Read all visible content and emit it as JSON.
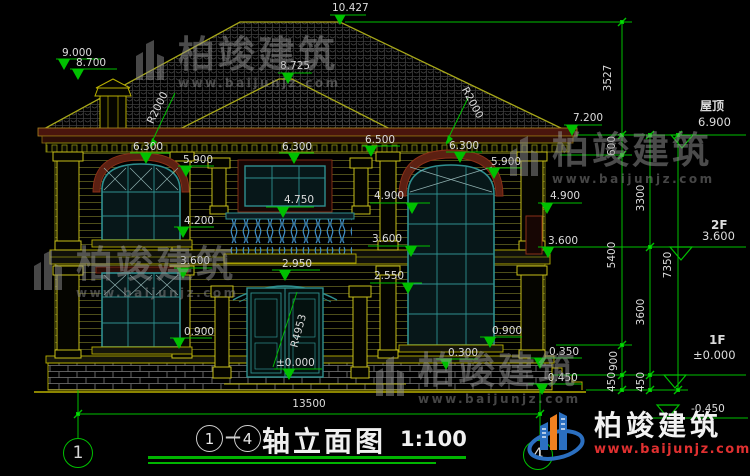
{
  "drawing": {
    "levels": {
      "apex": "10.427",
      "front_ridge": "8.725",
      "chimney_top": "9.000",
      "chimney_cap": "8.700",
      "eave_right": "7.200",
      "roof_tag": "屋顶",
      "roof": "6.900",
      "center_eave": "6.500",
      "e6300": "6.300",
      "e5900": "5.900",
      "e4900": "4.900",
      "e4750": "4.750",
      "e4200": "4.200",
      "e3600": "3.600",
      "e2950": "2.950",
      "e2550": "2.550",
      "e0900": "0.900",
      "e0300": "0.300",
      "e0350": "0.350",
      "neg450": "-0.450",
      "zero": "±0.000",
      "f2_tag": "2F",
      "f2_val": "3.600",
      "f1_tag": "1F",
      "f1_val": "±0.000",
      "grade": "-0.450"
    },
    "radii": {
      "roof_left": "R2000",
      "roof_right": "R2000",
      "door_arch": "R4953"
    },
    "dims": {
      "total": "13500",
      "roof_h": "3527",
      "d600": "600",
      "d3300": "3300",
      "d5400": "5400",
      "d7350": "7350",
      "d3600": "3600",
      "d900": "900",
      "d450": "450"
    },
    "axes": {
      "left": "1",
      "right": "4"
    }
  },
  "title": {
    "b1": "1",
    "dash": "—",
    "b2": "4",
    "text": "轴立面图",
    "scale": "1:100"
  },
  "watermark": {
    "brand": "柏竣建筑",
    "url": "www.baijunjz.com"
  },
  "logo": {
    "brand": "柏竣建筑",
    "url": "www.baijunjz.com"
  },
  "colors": {
    "background": "#000000",
    "dim_green": "#00c000",
    "cad_yellow": "#b9b000",
    "window_teal": "#2f8f8f",
    "trim_maroon": "#6b2417",
    "text": "#dcdcdc",
    "logo_blue": "#2b6fc0",
    "logo_orange": "#f08020",
    "logo_red": "#e03030",
    "watermark_gray": "#909090"
  }
}
